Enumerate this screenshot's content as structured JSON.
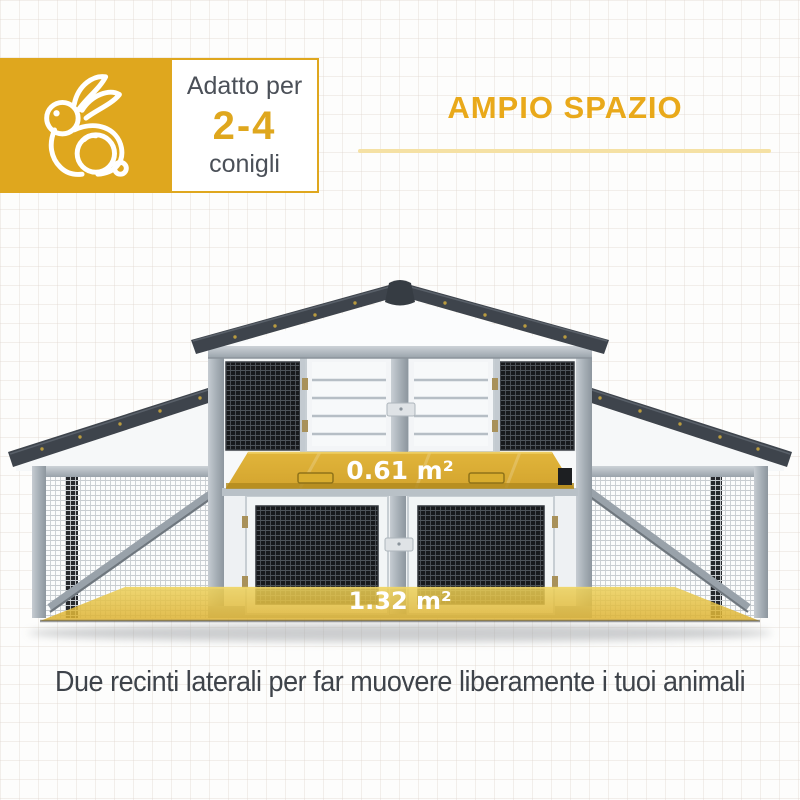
{
  "badge": {
    "prefix": "Adatto per",
    "range": "2-4",
    "suffix": "conigli",
    "icon": "rabbit-icon"
  },
  "header": {
    "title": "AMPIO SPAZIO"
  },
  "hutch": {
    "upper_area": "0.61 m²",
    "lower_area": "1.32 m²"
  },
  "caption": "Due recinti laterali per far muovere liberamente i tuoi animali",
  "colors": {
    "accent_gold": "#DFA71E",
    "title_gold": "#E9A91A",
    "divider": "#F5E1A4",
    "roof_dark": "#3E444C",
    "frame_gray": "#A9B1B8",
    "highlight_yellow": "#E3BA3C",
    "text_dark": "#3E434A"
  }
}
